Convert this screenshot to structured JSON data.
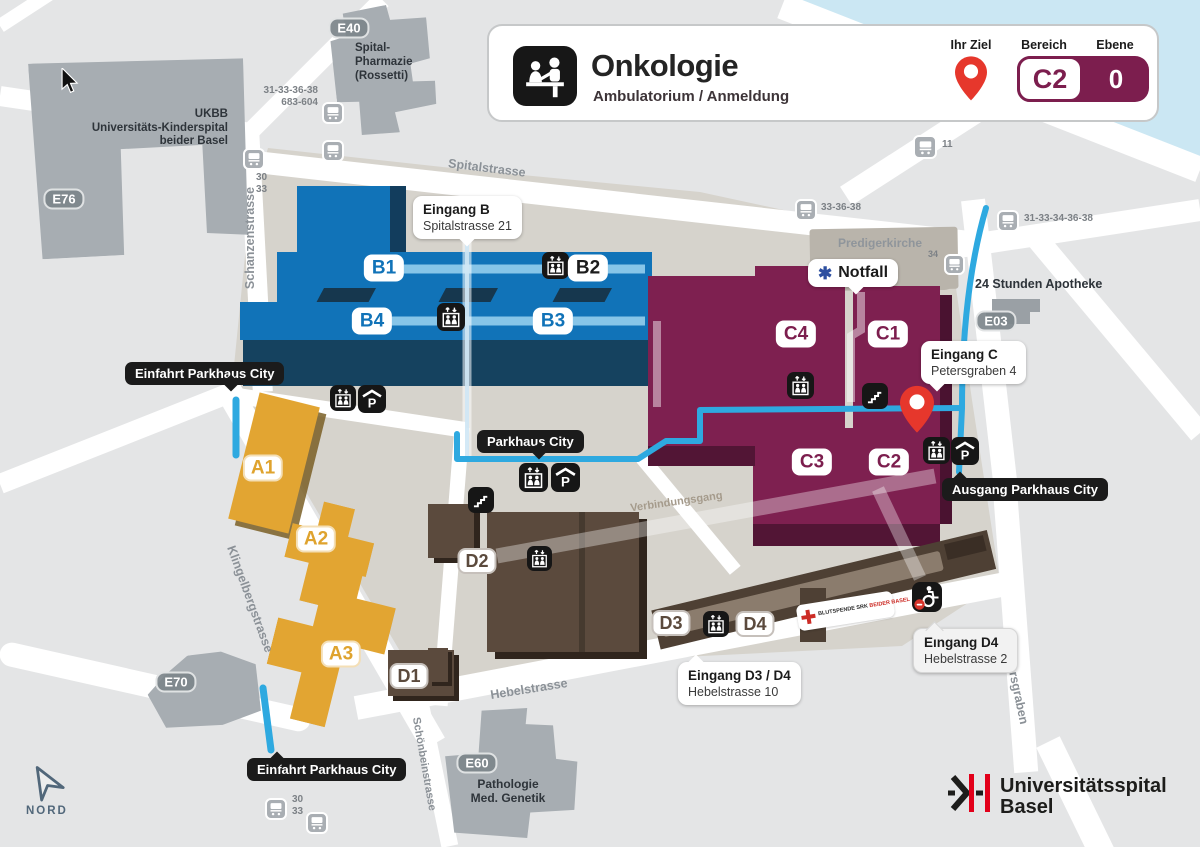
{
  "header": {
    "title": "Onkologie",
    "subtitle": "Ambulatorium / Anmeldung",
    "ihr_ziel": "Ihr Ziel",
    "bereich": "Bereich",
    "bereich_value": "C2",
    "ebene": "Ebene",
    "ebene_value": "0",
    "accent_color": "#7c1e4e",
    "pin_color": "#e6372c"
  },
  "badges": {
    "b1": "B1",
    "b2": "B2",
    "b3": "B3",
    "b4": "B4",
    "c1": "C1",
    "c2": "C2",
    "c3": "C3",
    "c4": "C4",
    "a1": "A1",
    "a2": "A2",
    "a3": "A3",
    "d1": "D1",
    "d2": "D2",
    "d3": "D3",
    "d4": "D4",
    "e40": "E40",
    "e76": "E76",
    "e03": "E03",
    "e70": "E70",
    "e60": "E60"
  },
  "callouts": {
    "eingang_b_title": "Eingang B",
    "eingang_b_sub": "Spitalstrasse 21",
    "eingang_c_title": "Eingang C",
    "eingang_c_sub": "Petersgraben 4",
    "eingang_d34_title": "Eingang D3 / D4",
    "eingang_d34_sub": "Hebelstrasse 10",
    "eingang_d4_title": "Eingang D4",
    "eingang_d4_sub": "Hebelstrasse 2",
    "notfall": "Notfall",
    "parkhaus_city": "Parkhaus City",
    "einfahrt_parkhaus_city": "Einfahrt Parkhaus City",
    "ausgang_parkhaus_city": "Ausgang Parkhaus City"
  },
  "streets": {
    "spitalstrasse": "Spitalstrasse",
    "schanzenstrasse": "Schanzenstrasse",
    "klingelbergstrasse": "Klingelbergstrasse",
    "hebelstrasse": "Hebelstrasse",
    "petersgraben": "Petersgraben",
    "schoenbeinstrasse": "Schönbeinstrasse",
    "verbindungsgang": "Verbindungsgang"
  },
  "places": {
    "ukbb1": "UKBB",
    "ukbb2": "Universitäts-Kinderspital",
    "ukbb3": "beider Basel",
    "pharmazie1": "Spital-",
    "pharmazie2": "Pharmazie",
    "pharmazie3": "(Rossetti)",
    "predigerkirche": "Predigerkirche",
    "apotheke": "24 Stunden Apotheke",
    "pathologie1": "Pathologie",
    "pathologie2": "Med. Genetik"
  },
  "tram": {
    "lines_nw1": "31-33-36-38",
    "lines_nw2": "683-604",
    "stop_30": "30",
    "stop_33": "33",
    "line_11": "11",
    "lines_ne": "33-36-38",
    "lines_e": "31-33-34-36-38",
    "line_34": "34"
  },
  "misc": {
    "north": "NORD",
    "blood1": "BLUTSPENDE SRK",
    "blood2": "BEIDER BASEL",
    "logo1": "Universitätsspital",
    "logo2": "Basel"
  }
}
